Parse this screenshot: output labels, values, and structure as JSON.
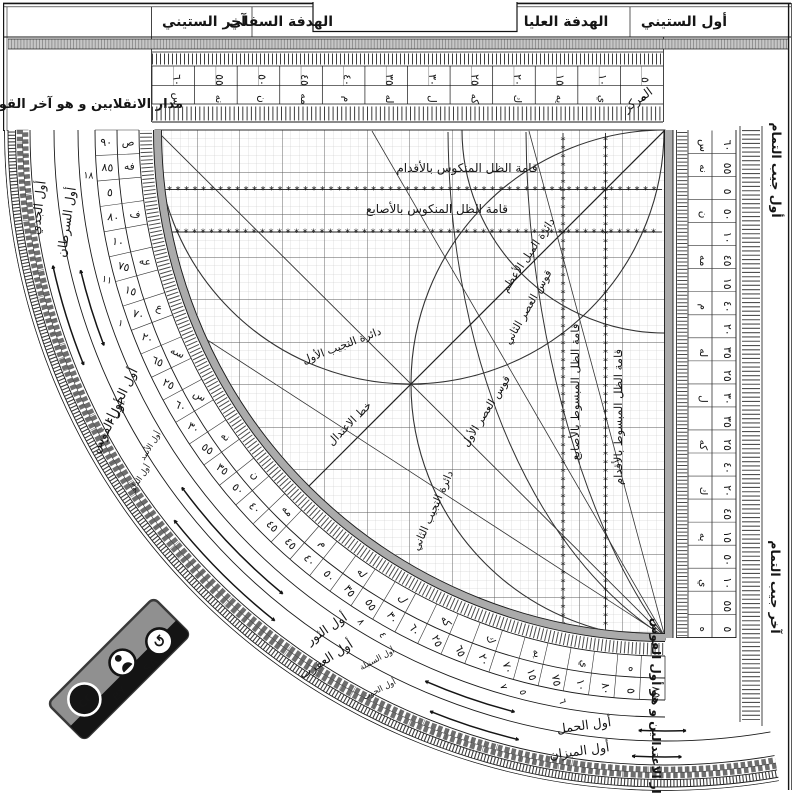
{
  "frame": {
    "titles": {
      "first_sixty": "أول الستيني",
      "upper_sight": "الهدفة العليا",
      "lower_sight": "الهدفة السفلي",
      "last_sixty": "آخر الستيني"
    },
    "top_left_label": "مدار الانقلابين و هو آخر القوس",
    "bottom_right_label": "مدار الاعتدالين و هو أول القوس",
    "center_label": "المركز",
    "cosine_start_label": "أول جيب التمام",
    "cosine_end_label": "آخر جيب التمام"
  },
  "scales": {
    "sixty_scale": {
      "numerals": [
        "٥",
        "١٠",
        "١٥",
        "٢٠",
        "٢٥",
        "٣٠",
        "٣٥",
        "٤٠",
        "٤٥",
        "٥٠",
        "٥٥",
        "٦٠"
      ],
      "abjad": [
        "ه",
        "ي",
        "يه",
        "ك",
        "كه",
        "ل",
        "له",
        "م",
        "مه",
        "ن",
        "نه",
        "س"
      ]
    },
    "arc_scale": {
      "cells": [
        {
          "v": "٩٠",
          "a": "ص"
        },
        {
          "v": "٨٥",
          "a": "فه"
        },
        {
          "v": "٥"
        },
        {
          "v": "٨٠",
          "a": "ف"
        },
        {
          "v": "١٠"
        },
        {
          "v": "٧٥",
          "a": "عه"
        },
        {
          "v": "١٥"
        },
        {
          "v": "٧٠",
          "a": "ع"
        },
        {
          "v": "٢٠"
        },
        {
          "v": "٦٥",
          "a": "سه"
        },
        {
          "v": "٢٥"
        },
        {
          "v": "٦٠",
          "a": "س"
        },
        {
          "v": "٣٠"
        },
        {
          "v": "٥٥",
          "a": "نه"
        },
        {
          "v": "٣٥"
        },
        {
          "v": "٥٠",
          "a": "ن"
        },
        {
          "v": "٤٠"
        },
        {
          "v": "٤٥",
          "a": "مه"
        },
        {
          "v": "٤٥"
        },
        {
          "v": "٤٠",
          "a": "م"
        },
        {
          "v": "٥٠"
        },
        {
          "v": "٣٥",
          "a": "له"
        },
        {
          "v": "٥٥"
        },
        {
          "v": "٣٠",
          "a": "ل"
        },
        {
          "v": "٦٠"
        },
        {
          "v": "٢٥",
          "a": "كه"
        },
        {
          "v": "٦٥"
        },
        {
          "v": "٢٠",
          "a": "ك"
        },
        {
          "v": "٧٠"
        },
        {
          "v": "١٥",
          "a": "يه"
        },
        {
          "v": "٧٥"
        },
        {
          "v": "١٠",
          "a": "ي"
        },
        {
          "v": "٨٠"
        },
        {
          "v": "٥",
          "a": "ه"
        },
        {
          "v": "٨٥"
        }
      ]
    },
    "cosine_scale": {
      "cells": [
        {
          "v": "٦٠",
          "a": "س"
        },
        {
          "v": "٥٥",
          "a": "نه"
        },
        {
          "v": "٥"
        },
        {
          "v": "٥٠",
          "a": "ن"
        },
        {
          "v": "١٠"
        },
        {
          "v": "٤٥",
          "a": "مه"
        },
        {
          "v": "١٥"
        },
        {
          "v": "٤٠",
          "a": "م"
        },
        {
          "v": "٢٠"
        },
        {
          "v": "٣٥",
          "a": "له"
        },
        {
          "v": "٢٥"
        },
        {
          "v": "٣٠",
          "a": "ل"
        },
        {
          "v": "٣٥"
        },
        {
          "v": "٢٥",
          "a": "كه"
        },
        {
          "v": "٤٠"
        },
        {
          "v": "٢٠",
          "a": "ك"
        },
        {
          "v": "٤٥"
        },
        {
          "v": "١٥",
          "a": "يه"
        },
        {
          "v": "٥٠"
        },
        {
          "v": "١٠",
          "a": "ي"
        },
        {
          "v": "٥٥"
        },
        {
          "v": "٥",
          "a": "ه"
        }
      ]
    },
    "minor_marks": [
      "١٨",
      "١١",
      "١",
      "٨",
      "٤",
      "٧",
      "٥",
      "٦"
    ]
  },
  "zodiac_bands": {
    "inner": [
      {
        "label": "أول السرطان"
      },
      {
        "label": "أول الجوزاء",
        "companion": "أول الأسد"
      },
      {
        "label": "أول الثور",
        "companion": "أول السنبلة"
      },
      {
        "label": "أول الحمل"
      }
    ],
    "outer": [
      {
        "label": "أول الجدي"
      },
      {
        "label": "أول القوس",
        "companion": "أول الدلو"
      },
      {
        "label": "أول العقرب",
        "companion": "أول الحوت"
      },
      {
        "label": "أول الميزان"
      }
    ]
  },
  "grid_labels": {
    "reversed_shadow_feet": "قامة الظل المنكوس بالأقدام",
    "reversed_shadow_digits": "قامة الظل المنكوس بالأصابع",
    "extended_shadow_feet": "قامة الظل المبسوط بالأقدام",
    "extended_shadow_digits": "قامة الظل المبسوط بالأصابع",
    "obliquity_circle": "دائرة الميل الأعظم",
    "first_sine_circle": "دائرة التجيب الأول",
    "second_sine_circle": "دائرة التجيب الثاني",
    "first_asr_arc": "قوس العصر الأول",
    "second_asr_arc": "قوس العصر الثاني",
    "equinox_line": "خط الاعتدال"
  },
  "badge": {
    "logo": "cc",
    "by": "BY",
    "sa": "SA"
  },
  "colors": {
    "ink": "#151515",
    "gray_band": "#c6c6c6",
    "rim_gray": "#aaaaaa",
    "grid_minor": "#c6c6c6",
    "grid_major": "#5a5a5a",
    "badge_gray": "#909090",
    "badge_black": "#141414"
  }
}
